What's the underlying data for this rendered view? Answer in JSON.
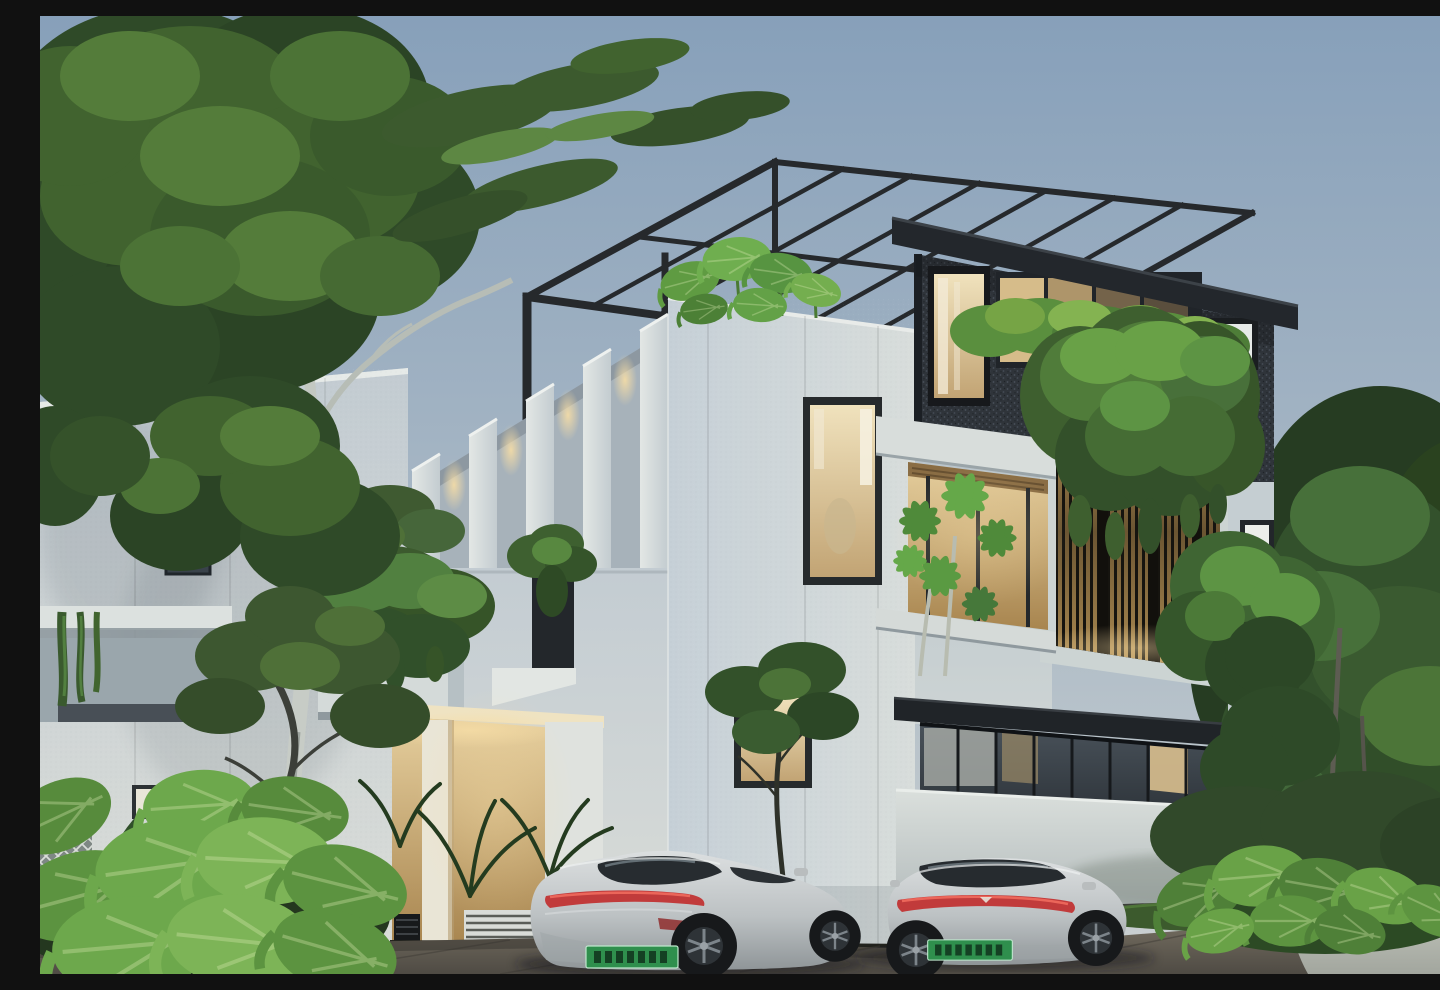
{
  "scene": {
    "title": "Modern villa exterior at dusk",
    "description": "Photorealistic architectural rendering of a modern three-storey villa at dusk: white panelled volumes, a charcoal speckled upper volume with warm-lit windows, a black steel rooftop pergola, a backlit timber slat screen draped with hanging vines, rooftop tropical plants and cascading planters, a glass curtain-wall ground floor behind a white boundary wall, two silver fastback electric sedans with green number plates parked on a paved driveway, a tall pale-trunk eucalyptus tree on the left and dense green trees on the right.",
    "time_of_day": "dusk",
    "setting": "residential street"
  },
  "building": {
    "storeys": 3,
    "features": [
      "black steel rooftop pergola",
      "charcoal speckled feature volume",
      "warm backlit timber slat screen",
      "white fin facade with downlights",
      "hanging vine planters",
      "rooftop tropical plants",
      "frosted vertical windows",
      "glass curtain-wall ground floor",
      "dark flat entrance canopy",
      "white boundary wall",
      "louvre and lattice vents",
      "warm-lit carport recess"
    ]
  },
  "vehicles": [
    {
      "id": "car-left",
      "type": "fastback electric sedan",
      "color": "silver",
      "view": "rear three-quarter",
      "tail_light": "full-width red light bar",
      "license_plate": {
        "style": "green EV plate",
        "legible": false
      }
    },
    {
      "id": "car-right",
      "type": "fastback electric sedan",
      "color": "silver",
      "view": "rear",
      "tail_light": "full-width red light bar",
      "license_plate": {
        "style": "green EV plate",
        "legible": false
      }
    }
  ],
  "vegetation": [
    "tall eucalyptus with pale trunk",
    "dense background trees",
    "elephant-ear shrubs",
    "palm fronds",
    "olive tree",
    "hanging vines",
    "balcony pachira plant",
    "lawn strip"
  ],
  "palette": {
    "sky_top": "#87a0ba",
    "sky_horizon": "#ccd1d1",
    "wall_white": "#d7dbd8",
    "wall_shade": "#bfc9d1",
    "charcoal": "#2f343a",
    "steel_black": "#26292c",
    "timber_slat": "#c5a369",
    "warm_light": "#f6dda6",
    "window_warm": "#e4cf9f",
    "glass_dark": "#2c3238",
    "foliage_dark": "#2f4a28",
    "foliage_light": "#6fa24a",
    "car_silver": "#c3c7c8",
    "tail_light_red": "#c13b3b",
    "plate_green": "#2f8f4d",
    "paving": "#6e675c",
    "path": "#b9bdb6"
  }
}
